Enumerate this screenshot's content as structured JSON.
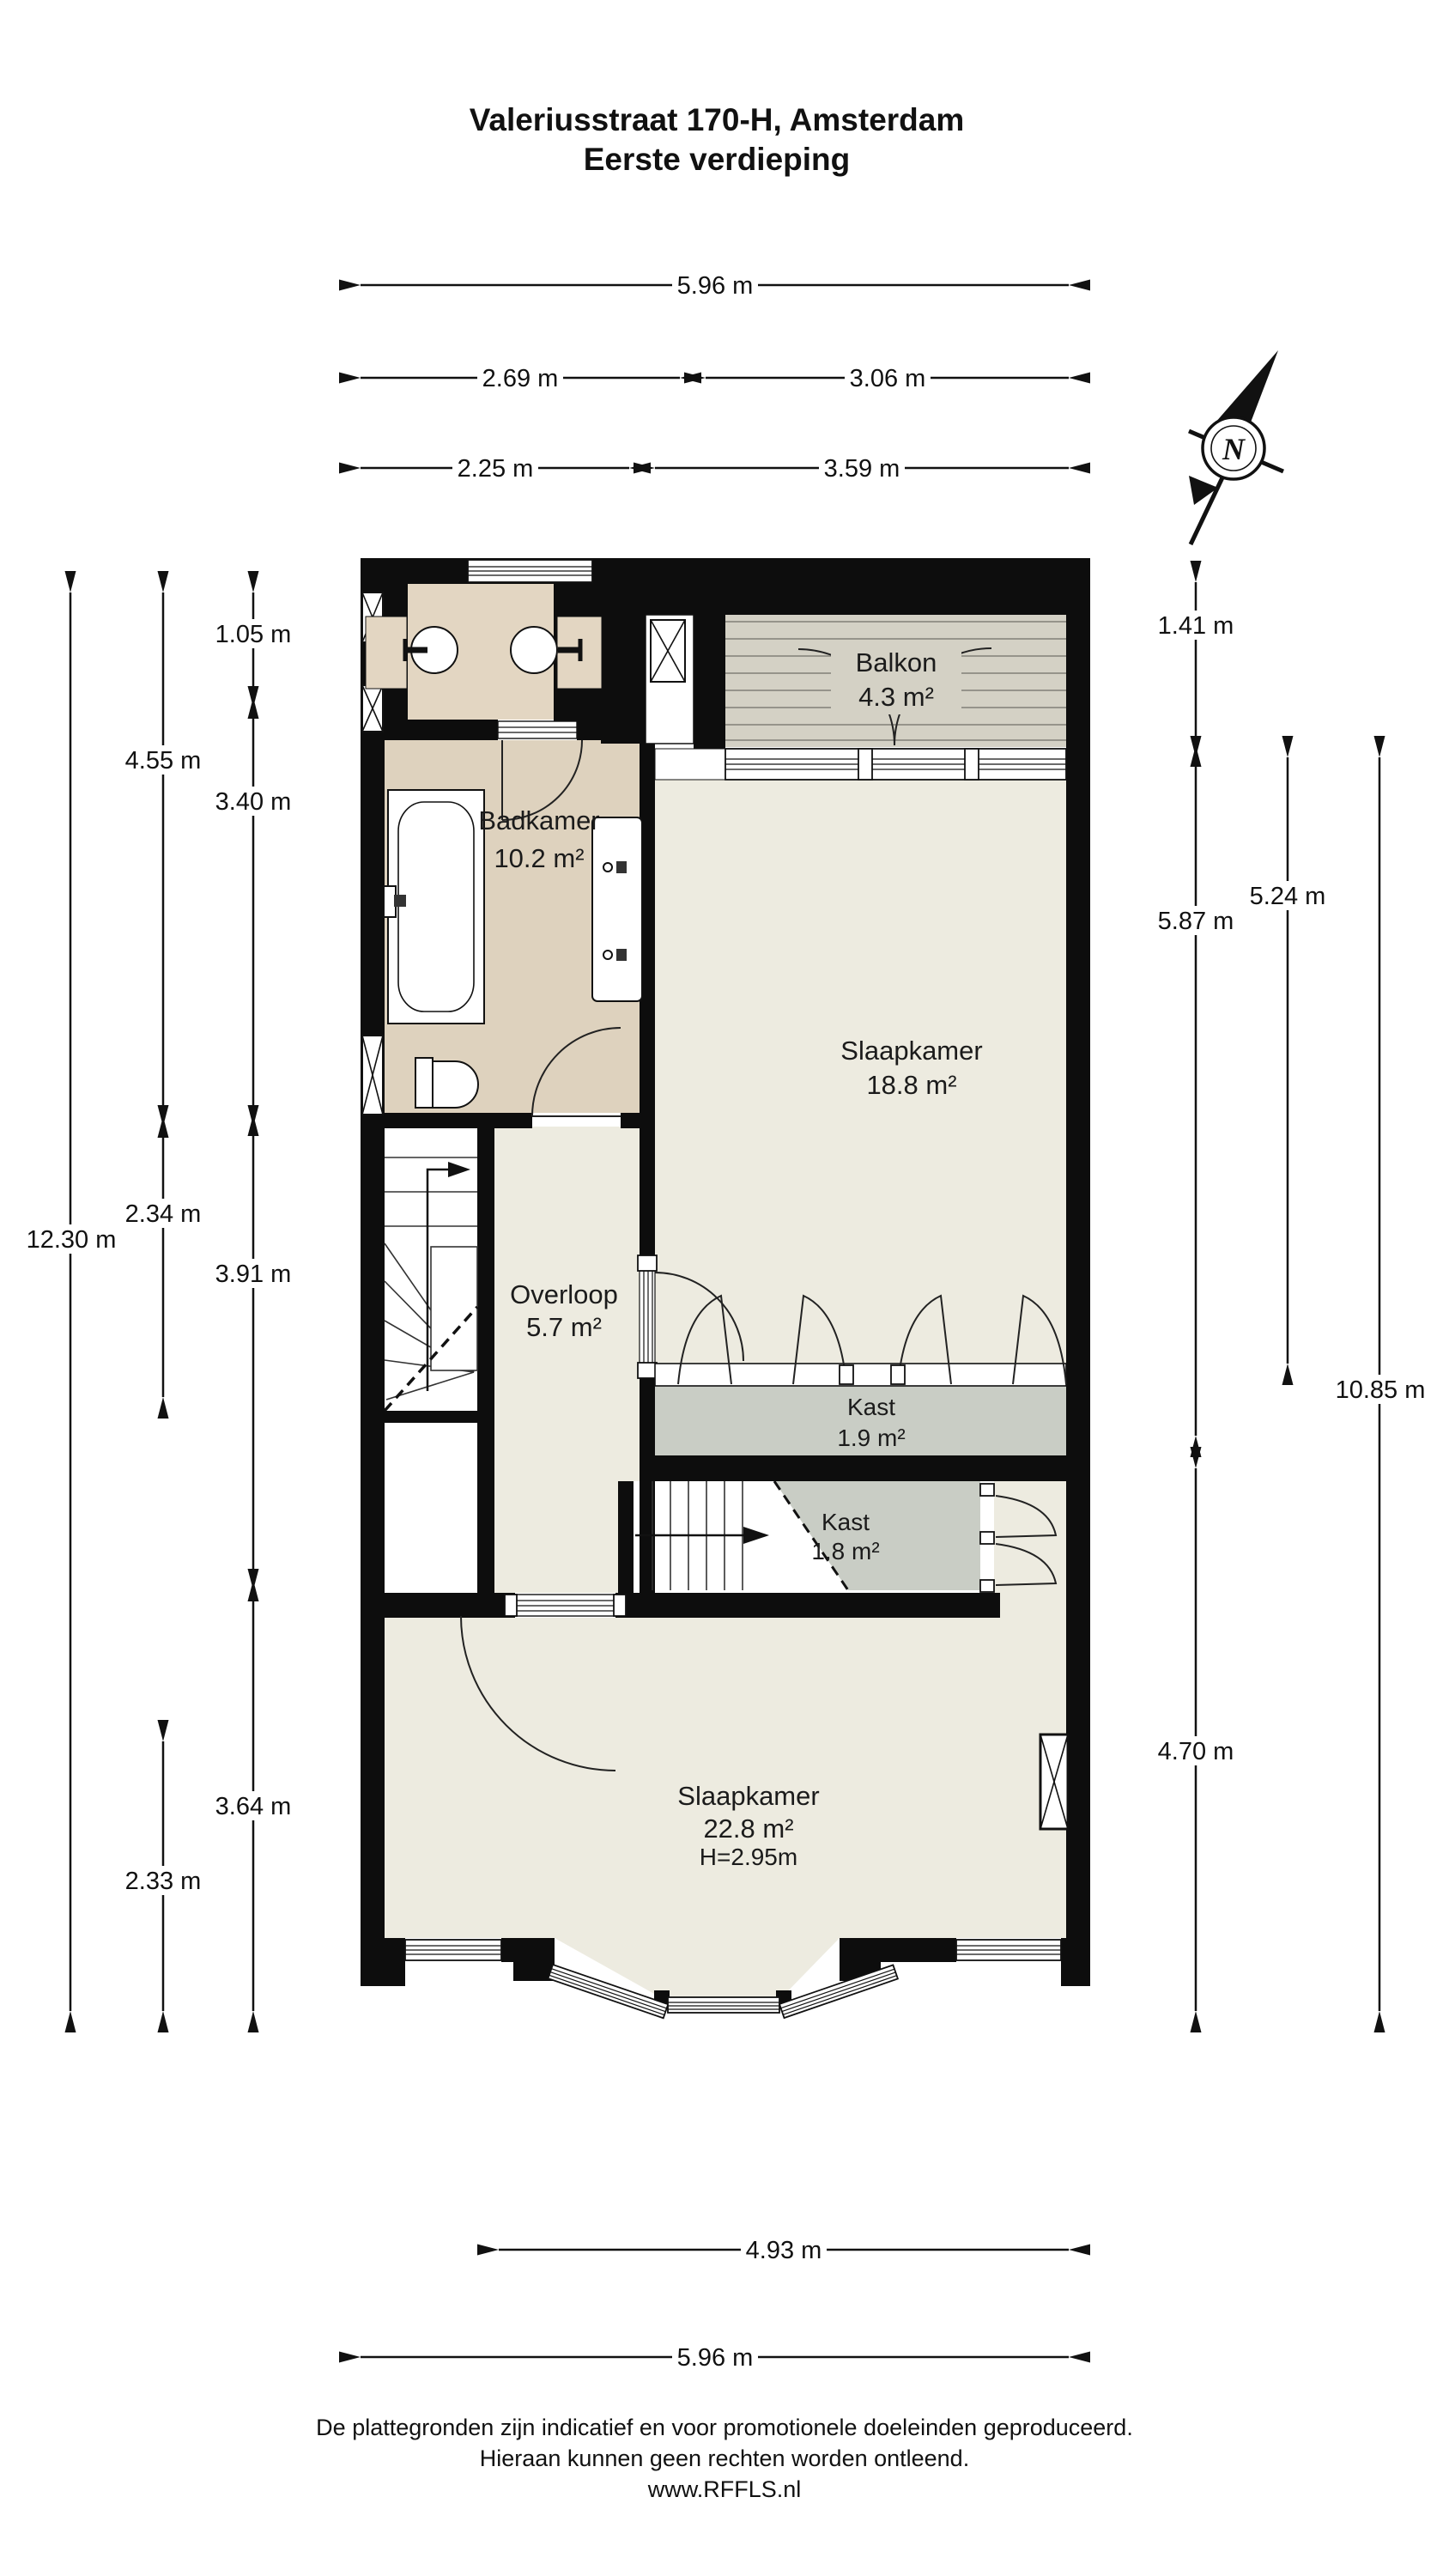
{
  "title": {
    "line1": "Valeriusstraat 170-H, Amsterdam",
    "line2": "Eerste verdieping"
  },
  "compass": {
    "label": "N"
  },
  "rooms": {
    "balkon": {
      "name": "Balkon",
      "area": "4.3 m²"
    },
    "badkamer": {
      "name": "Badkamer",
      "area": "10.2 m²"
    },
    "slaapkamer1": {
      "name": "Slaapkamer",
      "area": "18.8 m²"
    },
    "overloop": {
      "name": "Overloop",
      "area": "5.7 m²"
    },
    "kast1": {
      "name": "Kast",
      "area": "1.9 m²"
    },
    "kast2": {
      "name": "Kast",
      "area": "1.8 m²"
    },
    "slaapkamer2": {
      "name": "Slaapkamer",
      "area": "22.8 m²",
      "ceiling_height": "H=2.95m"
    }
  },
  "dimensions": {
    "top": [
      {
        "label": "5.96 m"
      },
      {
        "label": "2.69 m"
      },
      {
        "label": "3.06 m"
      },
      {
        "label": "2.25 m"
      },
      {
        "label": "3.59 m"
      }
    ],
    "left": [
      {
        "label": "1.05 m"
      },
      {
        "label": "4.55 m"
      },
      {
        "label": "3.40 m"
      },
      {
        "label": "12.30 m"
      },
      {
        "label": "2.34 m"
      },
      {
        "label": "3.91 m"
      },
      {
        "label": "3.64 m"
      },
      {
        "label": "2.33 m"
      }
    ],
    "right": [
      {
        "label": "1.41 m"
      },
      {
        "label": "5.87 m"
      },
      {
        "label": "5.24 m"
      },
      {
        "label": "10.85 m"
      },
      {
        "label": "4.70 m"
      }
    ],
    "bottom": [
      {
        "label": "4.93 m"
      },
      {
        "label": "5.96 m"
      }
    ]
  },
  "footer": {
    "line1": "De plattegronden zijn indicatief en voor promotionele doeleinden geproduceerd.",
    "line2": "Hieraan kunnen geen rechten worden ontleend.",
    "line3": "www.RFFLS.nl"
  },
  "colors": {
    "wall": "#0d0d0d",
    "floor_light": "#edebe0",
    "floor_bath": "#ded2be",
    "floor_annex": "#e3d6c2",
    "deck": "#d4d1c5",
    "closet": "#c9cdc5"
  }
}
